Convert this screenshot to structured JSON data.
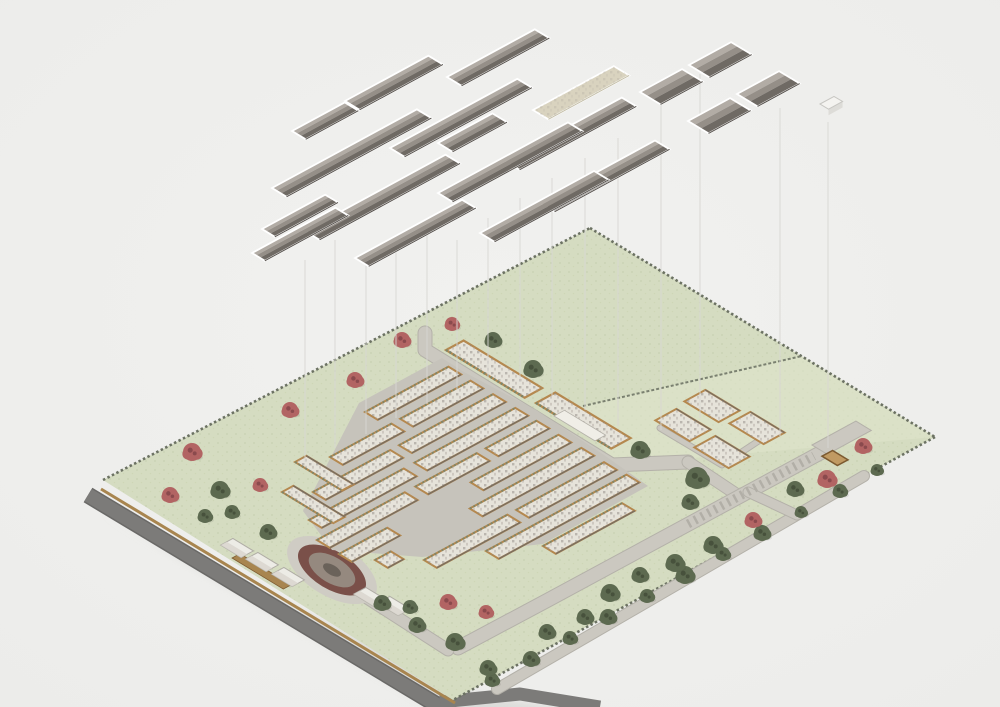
{
  "scene": {
    "axes": {
      "a": [
        0.878,
        -0.477
      ],
      "b": [
        0.855,
        0.518
      ]
    },
    "palette": {
      "bg": "#f0f0ee",
      "vignette_edge": "#e6e6e4",
      "grass": "#d5dcc1",
      "grass_light": "#e0e5cc",
      "hedge": "#6c7263",
      "divider": "#7a8070",
      "road_dark": "#7c7b79",
      "road_dark_edge": "#6a6967",
      "wall_tan": "#a8854f",
      "road": "#cbc8c0",
      "road_edge": "#b4b1a9",
      "parking_dash": "#b2afa7",
      "village_base": "#c6c3bb",
      "bldg_wall": "#b5884e",
      "bldg_floor": "#e6e3da",
      "bldg_dark_edge": "#6f6a64",
      "bldg_hedge": "#7d8568",
      "pool": "#f0eee7",
      "cottage": "#edece6",
      "cottage_dark": "#d8d5cd",
      "cottage_line": "#b0ada5",
      "hut_wall": "#a97f48",
      "hut_dark": "#7c5a30",
      "hut_floor": "#c09a62",
      "roof_hi": "#b2aca5",
      "roof_mid": "#958f88",
      "roof_lo": "#6f6a64",
      "roof_dark_line": "#57524d",
      "roof_outline": "#ffffff",
      "roof_flat": "#d9d3bf",
      "roof_flat_line": "#c5bfa8",
      "tree_green": "#5d6a50",
      "tree_green_dark": "#47513c",
      "tree_red": "#b26463",
      "tree_red_dark": "#8a4a4d",
      "pond_apron": "#cfccc4",
      "pond_ring": "#7a5049",
      "pond_water": "#95897f",
      "pond_core": "#6a625a",
      "court_pad": "#ccd6b0",
      "court_line": "#9aa681",
      "proj_line": "#d8d7d3",
      "shadow": "#d7d7d4",
      "cube_top": "#f4f3f0",
      "cube_side": "#dddcd8",
      "cube_line": "#c7c6c2"
    },
    "site": {
      "outline": [
        [
          103,
          480
        ],
        [
          590,
          228
        ],
        [
          935,
          437
        ],
        [
          453,
          700
        ]
      ],
      "light_field": [
        [
          583,
          406
        ],
        [
          802,
          356
        ],
        [
          935,
          437
        ],
        [
          612,
          465
        ]
      ],
      "field_divider": [
        [
          583,
          406
        ],
        [
          802,
          356
        ]
      ],
      "perimeter_hedges": [
        [
          [
            103,
            480
          ],
          [
            590,
            228
          ]
        ],
        [
          [
            590,
            228
          ],
          [
            935,
            437
          ]
        ],
        [
          [
            935,
            437
          ],
          [
            453,
            700
          ]
        ]
      ],
      "boundary_wall": [
        [
          101,
          489
        ],
        [
          455,
          703
        ]
      ],
      "dark_road": [
        [
          88,
          495
        ],
        [
          452,
          714
        ]
      ],
      "dark_road_wrap": [
        [
          440,
          702
        ],
        [
          520,
          694
        ],
        [
          600,
          707
        ]
      ],
      "ground_shadow": [
        [
          100,
          512
        ],
        [
          452,
          718
        ],
        [
          620,
          718
        ],
        [
          480,
          695
        ],
        [
          150,
          540
        ]
      ]
    },
    "roads": {
      "paved": [
        {
          "pts": [
            [
              425,
              333
            ],
            [
              425,
              350
            ],
            [
              612,
              465
            ],
            [
              688,
              462
            ]
          ],
          "w": 13
        },
        {
          "pts": [
            [
              688,
              462
            ],
            [
              739,
              496
            ]
          ],
          "w": 11
        },
        {
          "pts": [
            [
              822,
              452
            ],
            [
              548,
              600
            ],
            [
              458,
              648
            ]
          ],
          "w": 13
        },
        {
          "pts": [
            [
              297,
              553
            ],
            [
              448,
              650
            ]
          ],
          "w": 11
        },
        {
          "pts": [
            [
              864,
              476
            ],
            [
              497,
              689
            ]
          ],
          "w": 10
        },
        {
          "pts": [
            [
              748,
              492
            ],
            [
              797,
              515
            ]
          ],
          "w": 9
        },
        {
          "pts": [
            [
              660,
              428
            ],
            [
              722,
              465
            ],
            [
              760,
              440
            ]
          ],
          "w": 5
        }
      ],
      "parking_dashes": {
        "pts": [
          [
            688,
            524
          ],
          [
            814,
            456
          ]
        ],
        "w": 9
      },
      "parking_lot": {
        "s": [
          812,
          445
        ],
        "len": 50,
        "wid": 18
      }
    },
    "village": {
      "base_outline": [
        [
          442,
          358
        ],
        [
          359,
          403
        ],
        [
          303,
          511
        ],
        [
          332,
          550
        ],
        [
          422,
          557
        ],
        [
          543,
          544
        ],
        [
          648,
          486
        ],
        [
          604,
          455
        ],
        [
          536,
          410
        ],
        [
          464,
          372
        ]
      ],
      "row_width": 15,
      "rows": [
        {
          "s": [
            365,
            412
          ],
          "segs": [
            [
              0,
              95
            ]
          ]
        },
        {
          "s": [
            330,
            457
          ],
          "segs": [
            [
              0,
              70
            ],
            [
              80,
              80
            ]
          ]
        },
        {
          "s": [
            313,
            492
          ],
          "segs": [
            [
              0,
              88
            ],
            [
              98,
              107
            ]
          ]
        },
        {
          "s": [
            309,
            520
          ],
          "segs": [
            [
              0,
              108
            ],
            [
              120,
              115
            ]
          ]
        },
        {
          "s": [
            317,
            540
          ],
          "segs": [
            [
              0,
              100
            ],
            [
              112,
              70
            ],
            [
              192,
              58
            ]
          ]
        },
        {
          "s": [
            339,
            554
          ],
          "segs": [
            [
              0,
              55
            ],
            [
              150,
              100
            ]
          ]
        },
        {
          "s": [
            375,
            560
          ],
          "segs": [
            [
              0,
              18
            ],
            [
              108,
              127
            ]
          ]
        },
        {
          "s": [
            424,
            560
          ],
          "segs": [
            [
              0,
              95
            ],
            [
              105,
              100
            ]
          ]
        },
        {
          "s": [
            486,
            551
          ],
          "segs": [
            [
              0,
              160
            ]
          ]
        },
        {
          "s": [
            543,
            546
          ],
          "segs": [
            [
              0,
              90
            ]
          ]
        }
      ],
      "west_bars": [
        {
          "s": [
            295,
            462
          ],
          "len": 55,
          "wid": 13
        },
        {
          "s": [
            282,
            492
          ],
          "len": 60,
          "wid": 13
        }
      ],
      "wall_row": {
        "s": [
          232,
          558
        ],
        "len": 60,
        "wid": 9
      },
      "courtyard": {
        "c": [
          428,
          516
        ],
        "len": 58,
        "wid": 36
      },
      "pond": {
        "c": [
          332,
          570
        ],
        "angle": 31,
        "apron": [
          50,
          26
        ],
        "ring": [
          38,
          19
        ],
        "water": [
          26,
          13
        ],
        "core": [
          10,
          5
        ]
      }
    },
    "top_row": [
      {
        "s": [
          446,
          350
        ],
        "len": 92,
        "wid": 20
      },
      {
        "s": [
          536,
          403
        ],
        "len": 88,
        "wid": 22,
        "pool": {
          "s": [
            554,
            416
          ],
          "len": 48,
          "wid": 12
        }
      }
    ],
    "east_cluster": {
      "blocks": [
        {
          "c": [
            683,
            425
          ],
          "len": 40,
          "wid": 24
        },
        {
          "c": [
            712,
            406
          ],
          "len": 40,
          "wid": 24
        },
        {
          "c": [
            722,
            452
          ],
          "len": 40,
          "wid": 24
        },
        {
          "c": [
            757,
            428
          ],
          "len": 40,
          "wid": 24
        }
      ],
      "hut": {
        "c": [
          835,
          458
        ],
        "len": 18,
        "wid": 12
      }
    },
    "cottages": [
      {
        "c": [
          237,
          548
        ]
      },
      {
        "c": [
          262,
          562
        ]
      },
      {
        "c": [
          288,
          577
        ]
      },
      {
        "c": [
          370,
          597
        ]
      },
      {
        "c": [
          394,
          606
        ]
      }
    ],
    "trees": {
      "green": [
        [
          220,
          490,
          9
        ],
        [
          205,
          516,
          7
        ],
        [
          232,
          512,
          7
        ],
        [
          268,
          532,
          8
        ],
        [
          493,
          340,
          8
        ],
        [
          533,
          369,
          9
        ],
        [
          640,
          450,
          9
        ],
        [
          697,
          478,
          11
        ],
        [
          690,
          502,
          8
        ],
        [
          795,
          489,
          8
        ],
        [
          713,
          545,
          9
        ],
        [
          877,
          470,
          6
        ],
        [
          840,
          491,
          7
        ],
        [
          801,
          512,
          6
        ],
        [
          762,
          533,
          8
        ],
        [
          723,
          554,
          7
        ],
        [
          685,
          575,
          9
        ],
        [
          647,
          596,
          7
        ],
        [
          608,
          617,
          8
        ],
        [
          570,
          638,
          7
        ],
        [
          531,
          659,
          8
        ],
        [
          492,
          680,
          7
        ],
        [
          382,
          603,
          8
        ],
        [
          410,
          607,
          7
        ],
        [
          417,
          625,
          8
        ],
        [
          455,
          642,
          9
        ],
        [
          488,
          668,
          8
        ],
        [
          547,
          632,
          8
        ],
        [
          585,
          617,
          8
        ],
        [
          610,
          593,
          9
        ],
        [
          640,
          575,
          8
        ],
        [
          675,
          563,
          9
        ]
      ],
      "red": [
        [
          192,
          452,
          9
        ],
        [
          170,
          495,
          8
        ],
        [
          260,
          485,
          7
        ],
        [
          402,
          340,
          8
        ],
        [
          355,
          380,
          8
        ],
        [
          290,
          410,
          8
        ],
        [
          452,
          324,
          7
        ],
        [
          863,
          446,
          8
        ],
        [
          827,
          479,
          9
        ],
        [
          753,
          520,
          8
        ],
        [
          448,
          602,
          8
        ],
        [
          486,
          612,
          7
        ]
      ]
    },
    "projection_lines": [
      [
        305,
        260,
        462
      ],
      [
        335,
        240,
        448
      ],
      [
        366,
        260,
        434
      ],
      [
        396,
        240,
        418
      ],
      [
        427,
        218,
        404
      ],
      [
        457,
        240,
        390
      ],
      [
        488,
        218,
        378
      ],
      [
        520,
        198,
        382
      ],
      [
        552,
        178,
        396
      ],
      [
        585,
        158,
        410
      ],
      [
        618,
        138,
        426
      ],
      [
        661,
        95,
        430
      ],
      [
        700,
        74,
        418
      ],
      [
        780,
        108,
        436
      ],
      [
        828,
        122,
        448
      ]
    ],
    "roofs": {
      "panels": [
        {
          "s": [
            447,
            77
          ],
          "len": 100,
          "wid": 17
        },
        {
          "s": [
            533,
            110
          ],
          "len": 92,
          "wid": 18,
          "kind": "flat"
        },
        {
          "s": [
            345,
            101
          ],
          "len": 95,
          "wid": 17
        },
        {
          "s": [
            438,
            143
          ],
          "len": 62,
          "wid": 17
        },
        {
          "s": [
            505,
            161
          ],
          "len": 133,
          "wid": 17
        },
        {
          "s": [
            292,
            131
          ],
          "len": 60,
          "wid": 16
        },
        {
          "s": [
            272,
            188
          ],
          "len": 165,
          "wid": 17
        },
        {
          "s": [
            390,
            148
          ],
          "len": 145,
          "wid": 17
        },
        {
          "s": [
            305,
            231
          ],
          "len": 160,
          "wid": 17
        },
        {
          "s": [
            438,
            193
          ],
          "len": 148,
          "wid": 17
        },
        {
          "s": [
            540,
            203
          ],
          "len": 131,
          "wid": 17
        },
        {
          "s": [
            262,
            229
          ],
          "len": 72,
          "wid": 15
        },
        {
          "s": [
            252,
            253
          ],
          "len": 95,
          "wid": 15
        },
        {
          "s": [
            355,
            258
          ],
          "len": 122,
          "wid": 16
        },
        {
          "s": [
            480,
            233
          ],
          "len": 130,
          "wid": 17
        },
        {
          "s": [
            640,
            92
          ],
          "len": 48,
          "wid": 24
        },
        {
          "s": [
            689,
            65
          ],
          "len": 48,
          "wid": 24
        },
        {
          "s": [
            688,
            121
          ],
          "len": 48,
          "wid": 24
        },
        {
          "s": [
            737,
            94
          ],
          "len": 48,
          "wid": 24
        }
      ],
      "cube": {
        "s": [
          820,
          104
        ],
        "len": 16,
        "wid": 10
      }
    }
  }
}
